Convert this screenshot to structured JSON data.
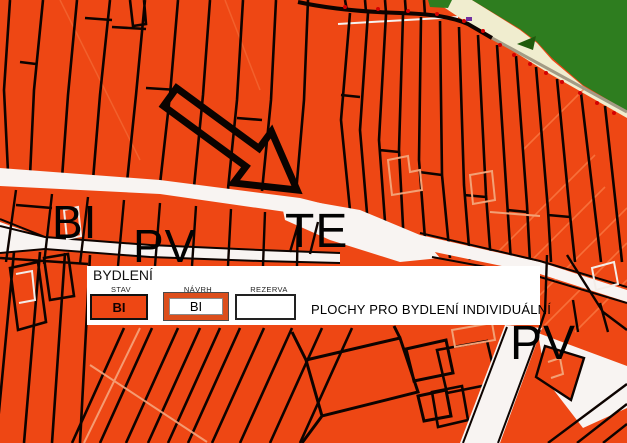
{
  "legend": {
    "title": "BYDLENÍ",
    "columns": [
      "STAV",
      "NÁVRH",
      "REZERVA"
    ],
    "swatches": [
      {
        "type": "stav",
        "label": "BI"
      },
      {
        "type": "navrh",
        "label": "BI"
      },
      {
        "type": "rezerva",
        "label": ""
      }
    ],
    "description": "PLOCHY PRO BYDLENÍ INDIVIDUÁLNÍ"
  },
  "map": {
    "labels": [
      {
        "id": "bi",
        "text": "BI"
      },
      {
        "id": "pv-left",
        "text": "PV"
      },
      {
        "id": "te",
        "text": "TE"
      },
      {
        "id": "pv-right",
        "text": "PV"
      }
    ],
    "colors": {
      "residential_orange": "#EE4714",
      "forest_green": "#2E7D1F",
      "field_cream": "#F0EDCF",
      "road_white": "#F8F4F2",
      "parcel_line_black": "#0D0300",
      "boundary_dot_red": "#D40000",
      "boundary_tan": "#A39B85"
    }
  }
}
